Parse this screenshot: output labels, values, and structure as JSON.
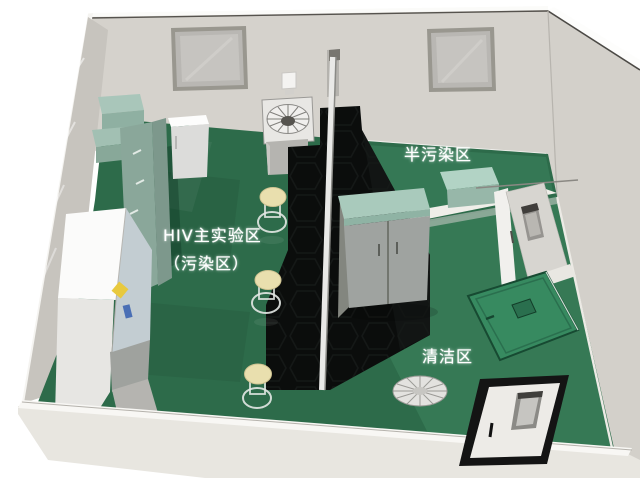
{
  "scene": {
    "type": "3d-laboratory-floorplan-render",
    "labels": {
      "main_area_line1": "HIV主实验区",
      "main_area_line2": "（污染区）",
      "semi_area": "半污染区",
      "clean_area": "清洁区"
    },
    "colors": {
      "background": "#ffffff",
      "wall_gray": "#d5d2cc",
      "left_wall": "#c7c4be",
      "front_wall": "#e8e6e0",
      "floor_green": "#2d6b4a",
      "clean_floor_green": "#317953",
      "bench_black": "#0b0d0c",
      "cabinet_teal": "#9fbfb1",
      "wardrobe_gray": "#9fa3a0",
      "stool_cream": "#e9dfae",
      "warning_yellow": "#e8c93e",
      "label_text": "#ffffff",
      "door_frame_black": "#141414"
    },
    "objects": [
      "back-wall-windows",
      "wall-switch",
      "centrifuge-fan-unit",
      "refrigerator",
      "side-counters",
      "drawer-cabinet",
      "biosafety-cabinet",
      "black-lab-bench",
      "service-pole",
      "lab-stools",
      "storage-wardrobe",
      "side-table",
      "pass-through-door",
      "open-floor-door",
      "floor-exhaust-fan",
      "entry-door"
    ]
  }
}
